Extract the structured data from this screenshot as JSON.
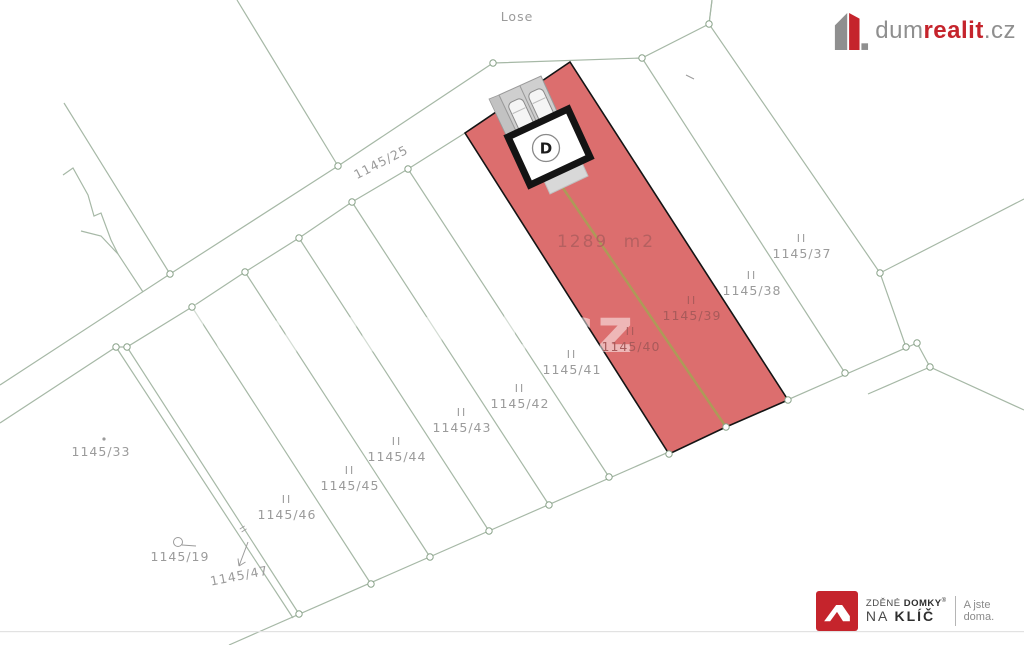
{
  "map": {
    "line_color": "#a6b8a6",
    "label_color": "#9b9b9b",
    "red_label_color": "#a85a5a",
    "highlight": {
      "area_label": "1289 m2",
      "marker_letter": "D",
      "fill": "#dc6e6e",
      "outline": "#141414",
      "parcel_numbers": [
        "1145/39",
        "1145/40"
      ]
    },
    "labels": [
      {
        "text": "Lose",
        "x": 517,
        "y": 21,
        "rot": 0,
        "cls": "gray",
        "ii": false
      },
      {
        "text": "1145/25",
        "x": 383,
        "y": 166,
        "rot": -27,
        "cls": "gray",
        "ii": false
      },
      {
        "text": "1145/33",
        "x": 101,
        "y": 456,
        "rot": 0,
        "cls": "gray",
        "ii": false
      },
      {
        "text": "1145/19",
        "x": 180,
        "y": 561,
        "rot": 0,
        "cls": "gray",
        "ii": false
      },
      {
        "text": "1145/47",
        "x": 240,
        "y": 580,
        "rot": -11,
        "cls": "gray",
        "ii": false
      },
      {
        "text": "1145/46",
        "x": 287,
        "y": 519,
        "rot": 0,
        "cls": "gray",
        "ii": true
      },
      {
        "text": "1145/45",
        "x": 350,
        "y": 490,
        "rot": 0,
        "cls": "gray",
        "ii": true
      },
      {
        "text": "1145/44",
        "x": 397,
        "y": 461,
        "rot": 0,
        "cls": "gray",
        "ii": true
      },
      {
        "text": "1145/43",
        "x": 462,
        "y": 432,
        "rot": 0,
        "cls": "gray",
        "ii": true
      },
      {
        "text": "1145/42",
        "x": 520,
        "y": 408,
        "rot": 0,
        "cls": "gray",
        "ii": true
      },
      {
        "text": "1145/41",
        "x": 572,
        "y": 374,
        "rot": 0,
        "cls": "gray",
        "ii": true
      },
      {
        "text": "1145/40",
        "x": 631,
        "y": 351,
        "rot": 0,
        "cls": "red",
        "ii": true
      },
      {
        "text": "1145/39",
        "x": 692,
        "y": 320,
        "rot": 0,
        "cls": "red",
        "ii": true
      },
      {
        "text": "1145/38",
        "x": 752,
        "y": 295,
        "rot": 0,
        "cls": "gray",
        "ii": true
      },
      {
        "text": "1145/37",
        "x": 802,
        "y": 258,
        "rot": 0,
        "cls": "gray",
        "ii": true
      },
      {
        "text": "II",
        "x": 241,
        "y": 531,
        "rot": 57,
        "cls": "gray",
        "ii": false,
        "size": 8
      }
    ]
  },
  "watermark": {
    "text": "dumrealit.cz"
  },
  "header_logo": {
    "dum": "dum",
    "realit": "realit",
    "cz": ".cz"
  },
  "footer_logo": {
    "line1_light": "ZDĚNÉ",
    "line1_bold": "DOMKY",
    "registered": "®",
    "line2_light": "NA",
    "line2_bold": "KLÍČ",
    "tagline": "A jste doma.",
    "brand_red": "#c5242c"
  }
}
